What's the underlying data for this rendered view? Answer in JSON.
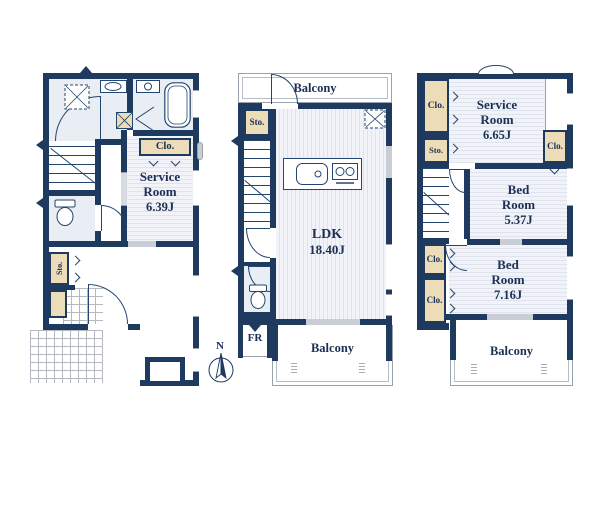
{
  "colors": {
    "wall": "#1e3a5e",
    "closet_fill": "#ecdcb8",
    "floor_stripe": "#dfe3ed",
    "wet_area": "#e8eef3",
    "text": "#1c2f54",
    "fence": "#9aa3ad",
    "window_gray": "#c9ced6"
  },
  "f1": {
    "clo": "Clo.",
    "sto": "Sto.",
    "service_l1": "Service",
    "service_l2": "Room",
    "service_l3": "6.39J"
  },
  "f2": {
    "balcony_top": "Balcony",
    "sto": "Sto.",
    "ldk_l1": "LDK",
    "ldk_l2": "18.40J",
    "fr": "FR",
    "balcony_bottom": "Balcony"
  },
  "f3": {
    "clo_top_left": "Clo.",
    "sto": "Sto.",
    "service_l1": "Service",
    "service_l2": "Room",
    "service_l3": "6.65J",
    "clo_right": "Clo.",
    "bed1_l1": "Bed",
    "bed1_l2": "Room",
    "bed1_l3": "5.37J",
    "clo_left_1": "Clo.",
    "clo_left_2": "Clo.",
    "bed2_l1": "Bed",
    "bed2_l2": "Room",
    "bed2_l3": "7.16J",
    "balcony": "Balcony"
  },
  "compass": {
    "north": "N"
  }
}
